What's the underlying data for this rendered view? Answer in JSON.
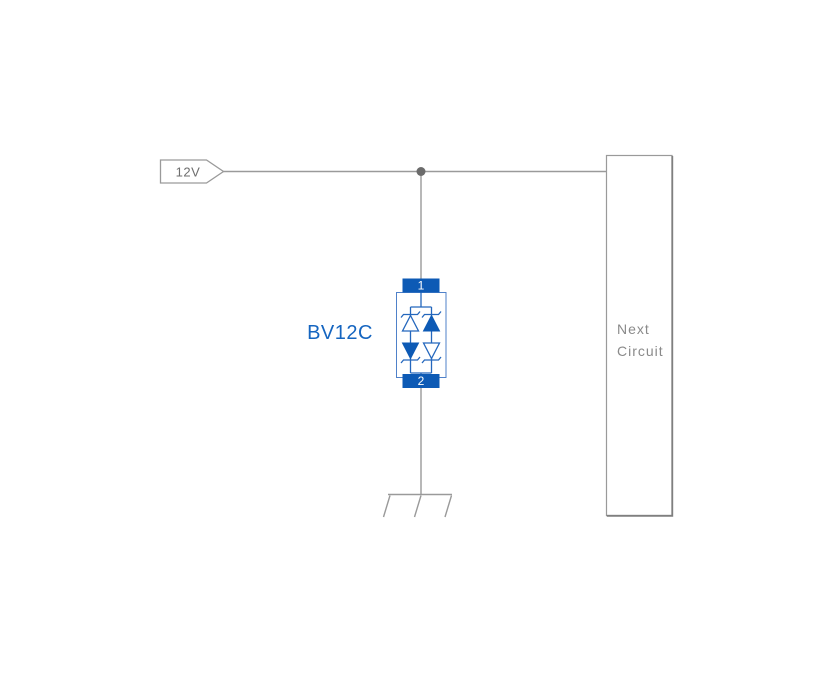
{
  "colors": {
    "background": "#ffffff",
    "accent_blue": "#0d5ab5",
    "device_stroke_blue": "#2467bd",
    "device_outline_blue": "#4f81c9",
    "device_label_blue": "#1565c0",
    "wire_gray": "#9a9a9a",
    "junction_gray": "#6b6b6b",
    "net_label_gray": "#6e6e6e",
    "block_text_gray": "#8a8a8a",
    "pin_text_white": "#ffffff"
  },
  "diagram": {
    "power_net": {
      "label": "12V"
    },
    "protection_device": {
      "name": "BV12C",
      "pins": [
        {
          "number": "1"
        },
        {
          "number": "2"
        }
      ]
    },
    "next_circuit": {
      "label": "Next Circuit",
      "lines": [
        "Next",
        "Circuit"
      ]
    }
  }
}
